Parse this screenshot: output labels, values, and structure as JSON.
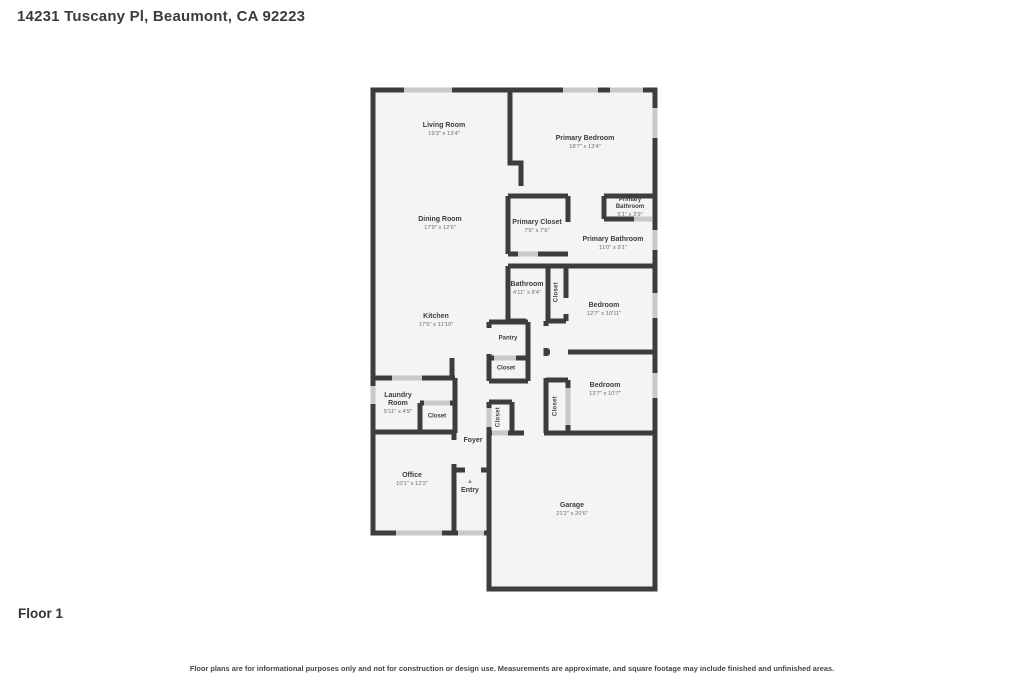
{
  "page": {
    "title": "14231 Tuscany Pl, Beaumont, CA 92223",
    "floor_label": "Floor 1",
    "disclaimer": "Floor plans are for informational purposes only and not for construction or design use. Measurements are approximate, and square footage may include finished and unfinished areas."
  },
  "colors": {
    "wall": "#3d3d3d",
    "window_door": "#c9c9c9",
    "room_fill": "#f4f4f4",
    "room_name_text": "#3d3d3d",
    "room_dims_text": "#6e6e6e"
  },
  "icons": {
    "entry_marker": "▲"
  },
  "rooms": [
    {
      "name": "Living Room",
      "dims": "19'3\" x 13'4\""
    },
    {
      "name": "Primary Bedroom",
      "dims": "18'7\" x 13'4\""
    },
    {
      "name": "Dining Room",
      "dims": "17'9\" x 12'6\""
    },
    {
      "name": "Primary Closet",
      "dims": "7'6\" x 7'6\""
    },
    {
      "name": "Primary Bathroom",
      "dims": "5'1\" x 3'9\""
    },
    {
      "name": "Primary Bathroom",
      "dims": "11'0\" x 9'1\""
    },
    {
      "name": "Bathroom",
      "dims": "4'11\" x 8'4\""
    },
    {
      "name": "Closet",
      "dims": ""
    },
    {
      "name": "Bedroom",
      "dims": "12'7\" x 10'11\""
    },
    {
      "name": "Kitchen",
      "dims": "17'5\" x 11'10\""
    },
    {
      "name": "Pantry",
      "dims": ""
    },
    {
      "name": "Closet",
      "dims": ""
    },
    {
      "name": "Laundry Room",
      "dims": "5'11\" x 4'9\""
    },
    {
      "name": "Closet",
      "dims": ""
    },
    {
      "name": "Closet",
      "dims": ""
    },
    {
      "name": "Bedroom",
      "dims": "12'7\" x 10'7\""
    },
    {
      "name": "Closet",
      "dims": ""
    },
    {
      "name": "Foyer",
      "dims": ""
    },
    {
      "name": "Office",
      "dims": "10'1\" x 12'2\""
    },
    {
      "name": "Entry",
      "dims": ""
    },
    {
      "name": "Garage",
      "dims": "21'2\" x 20'6\""
    }
  ]
}
